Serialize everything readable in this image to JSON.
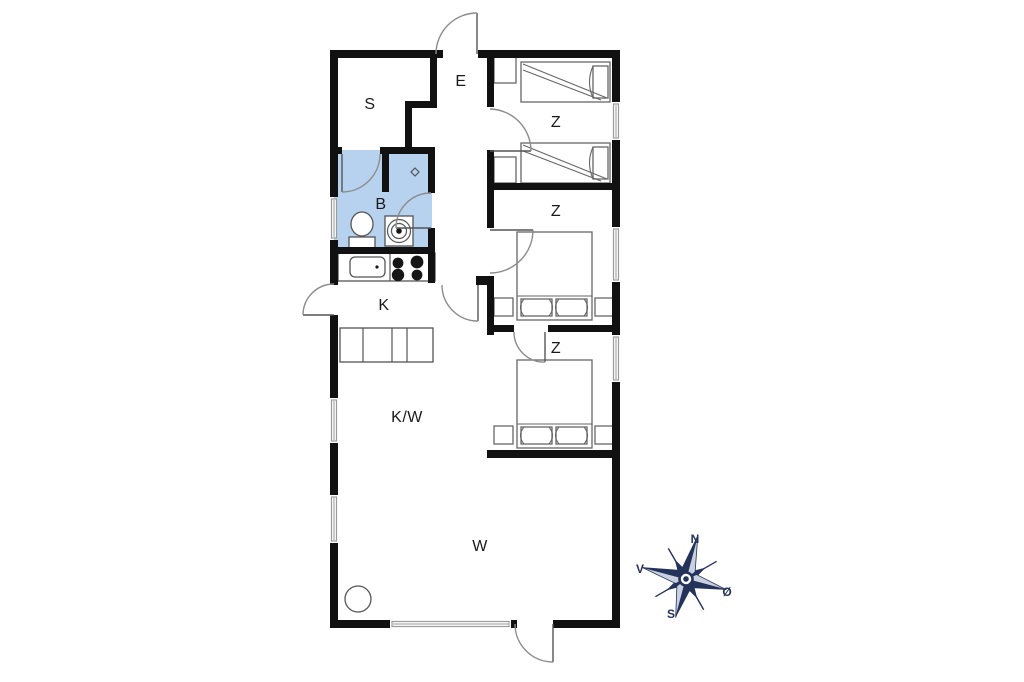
{
  "floorplan": {
    "rooms": [
      {
        "id": "s-room",
        "label": "S"
      },
      {
        "id": "entrance",
        "label": "E"
      },
      {
        "id": "bedroom-top",
        "label": "Z"
      },
      {
        "id": "bathroom",
        "label": "B"
      },
      {
        "id": "bedroom-middle",
        "label": "Z"
      },
      {
        "id": "kitchen",
        "label": "K"
      },
      {
        "id": "bedroom-bottom",
        "label": "Z"
      },
      {
        "id": "kitchen-living",
        "label": "K/W"
      },
      {
        "id": "living-room",
        "label": "W"
      }
    ],
    "compass": {
      "north": "N",
      "east": "Ø",
      "south": "S",
      "west": "V"
    },
    "icons": {
      "toilet": "toilet-icon",
      "washbasin": "washbasin-icon",
      "shower": "shower-icon",
      "kitchen_sink": "kitchen-sink-icon",
      "stove_burners": "stove-burners-icon",
      "wood_stove": "wood-stove-icon",
      "compass_rose": "compass-rose-icon"
    },
    "colors": {
      "background": "#ffffff",
      "wall": "#111111",
      "line": "#8c8c8c",
      "fixture_line": "#555555",
      "bathroom_fill": "#b7d2ee",
      "compass_dark": "#24335a",
      "compass_light": "#c9d1e0"
    }
  }
}
